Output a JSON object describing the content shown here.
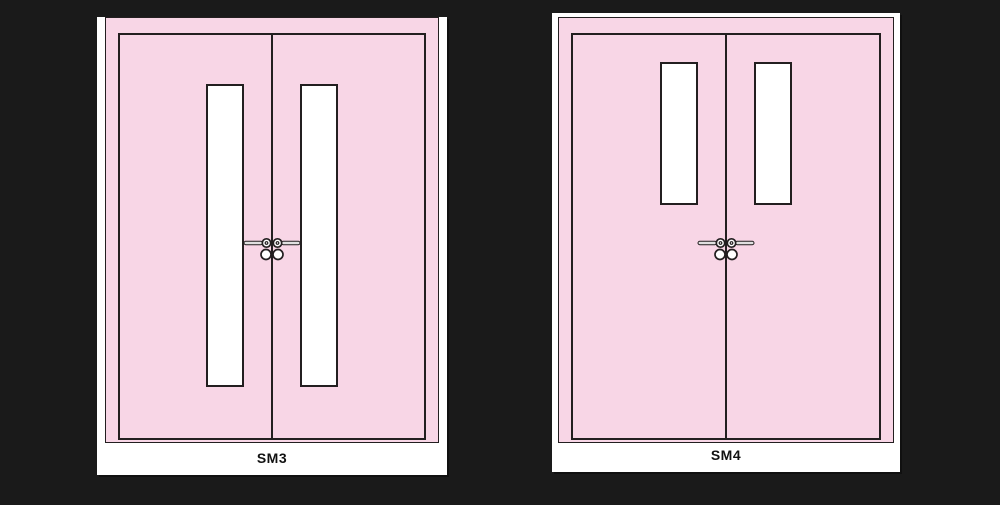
{
  "colors": {
    "background": "#1a1a1a",
    "card": "#ffffff",
    "door": "#f8d6e6",
    "outline": "#231f20",
    "glass": "#ffffff",
    "hardware_metal": "#e0e0e0"
  },
  "panels": [
    {
      "label": "SM3",
      "type": "double-door-elevation",
      "vision_panel": "tall"
    },
    {
      "label": "SM4",
      "type": "double-door-elevation",
      "vision_panel": "short"
    }
  ],
  "hardware": {
    "name": "lever-handle-with-cylinder"
  }
}
